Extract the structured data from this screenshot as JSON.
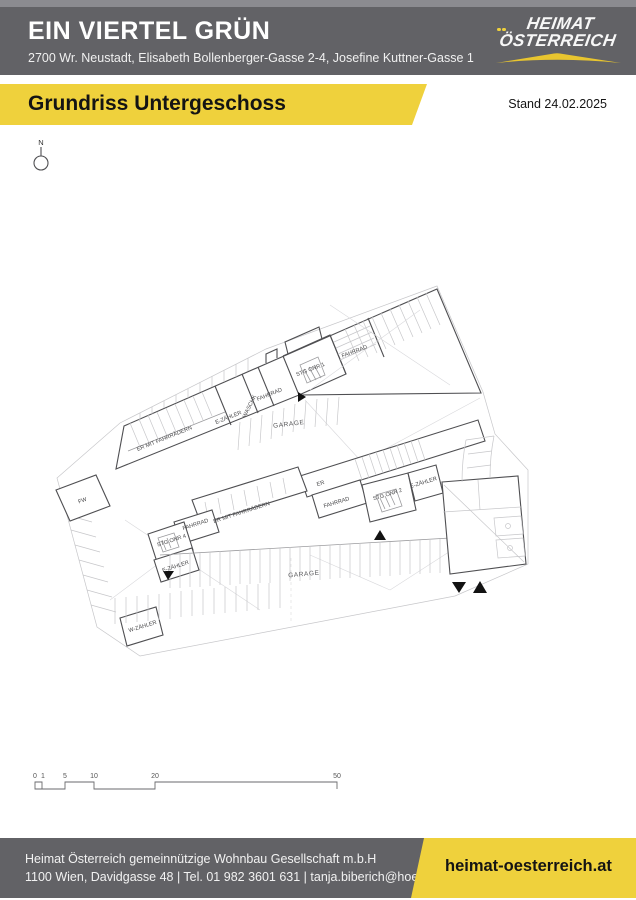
{
  "header": {
    "title": "EIN VIERTEL GRÜN",
    "address": "2700 Wr. Neustadt, Elisabeth Bollenberger-Gasse 2-4, Josefine Kuttner-Gasse 1",
    "logo": {
      "line1": "HEIMAT",
      "line2": "ÖSTERREICH"
    }
  },
  "banner": {
    "title": "Grundriss Untergeschoss",
    "stand": "Stand 24.02.2025"
  },
  "plan": {
    "north": "N",
    "labels": [
      {
        "text": "STG ONR 1"
      },
      {
        "text": "FAHRRAD"
      },
      {
        "text": "FAHRRAD"
      },
      {
        "text": "WASCHK"
      },
      {
        "text": "E-ZÄHLER"
      },
      {
        "text": "ER MIT FAHRRÄDERN"
      },
      {
        "text": "GARAGE"
      },
      {
        "text": "FW"
      },
      {
        "text": "ER"
      },
      {
        "text": "FAHRRAD"
      },
      {
        "text": "STG ONR 2"
      },
      {
        "text": "E-ZÄHLER"
      },
      {
        "text": "ER MIT FAHRRÄDERN"
      },
      {
        "text": "FAHRRAD"
      },
      {
        "text": "STG.ONR 4"
      },
      {
        "text": "E-ZÄHLER"
      },
      {
        "text": "GARAGE"
      },
      {
        "text": "W-ZÄHLER"
      }
    ]
  },
  "scalebar": {
    "labels": [
      "0",
      "1",
      "5",
      "10",
      "20",
      "50"
    ]
  },
  "footer": {
    "company": "Heimat Österreich gemeinnützige Wohnbau Gesellschaft m.b.H",
    "contact": "1100 Wien, Davidgasse 48 | Tel. 01 982 3601 631 | tanja.biberich@hoe.at",
    "website": "heimat-oesterreich.at"
  },
  "colors": {
    "header_gray": "#626266",
    "accent_yellow": "#efd13c"
  }
}
